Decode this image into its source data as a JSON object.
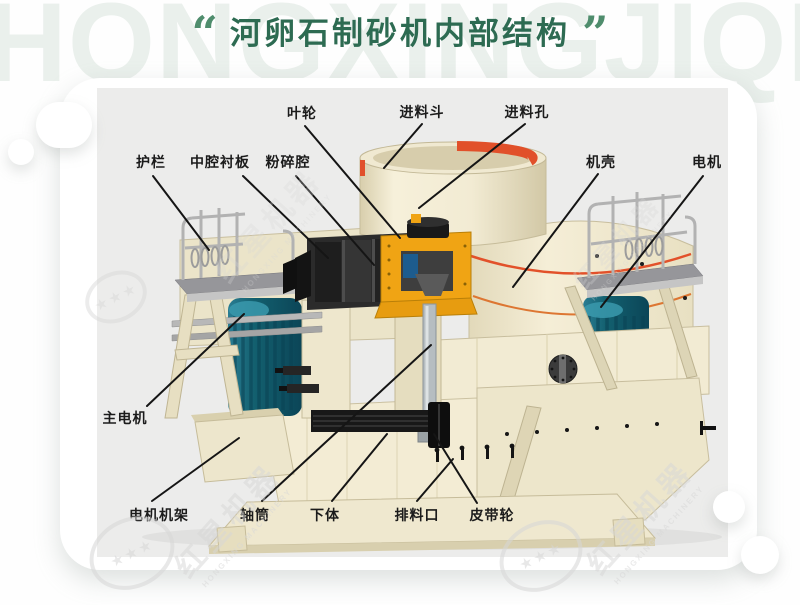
{
  "header": {
    "watermark": "HONGXINGJIQI",
    "quote_open": "“",
    "quote_close": "”",
    "title": "河卵石制砂机内部结构"
  },
  "diagram": {
    "labels": [
      {
        "id": "impeller",
        "text": "叶轮"
      },
      {
        "id": "feed-hopper",
        "text": "进料斗"
      },
      {
        "id": "feed-port",
        "text": "进料孔"
      },
      {
        "id": "guardrail",
        "text": "护栏"
      },
      {
        "id": "cavity-liner",
        "text": "中腔衬板"
      },
      {
        "id": "crushing-chamber",
        "text": "粉碎腔"
      },
      {
        "id": "casing",
        "text": "机壳"
      },
      {
        "id": "motor",
        "text": "电机"
      },
      {
        "id": "main-motor",
        "text": "主电机"
      },
      {
        "id": "motor-frame",
        "text": "电机机架"
      },
      {
        "id": "shaft-tube",
        "text": "轴筒"
      },
      {
        "id": "lower-body",
        "text": "下体"
      },
      {
        "id": "discharge-port",
        "text": "排料口"
      },
      {
        "id": "belt-pulley",
        "text": "皮带轮"
      }
    ],
    "watermark": {
      "cn": "红星机器",
      "en": "HONGXING MACHINERY",
      "stars": "★★★"
    }
  },
  "colors": {
    "title_green": "#2d6b52",
    "quote_green": "#4f8d6d",
    "panel_gray": "#ececeb",
    "machine_cream": "#f1ead2",
    "motor_teal": "#14616f",
    "rotor_yellow": "#f0a414",
    "hopper_ring_red": "#e1502a",
    "trim_orange": "#dd7632"
  }
}
